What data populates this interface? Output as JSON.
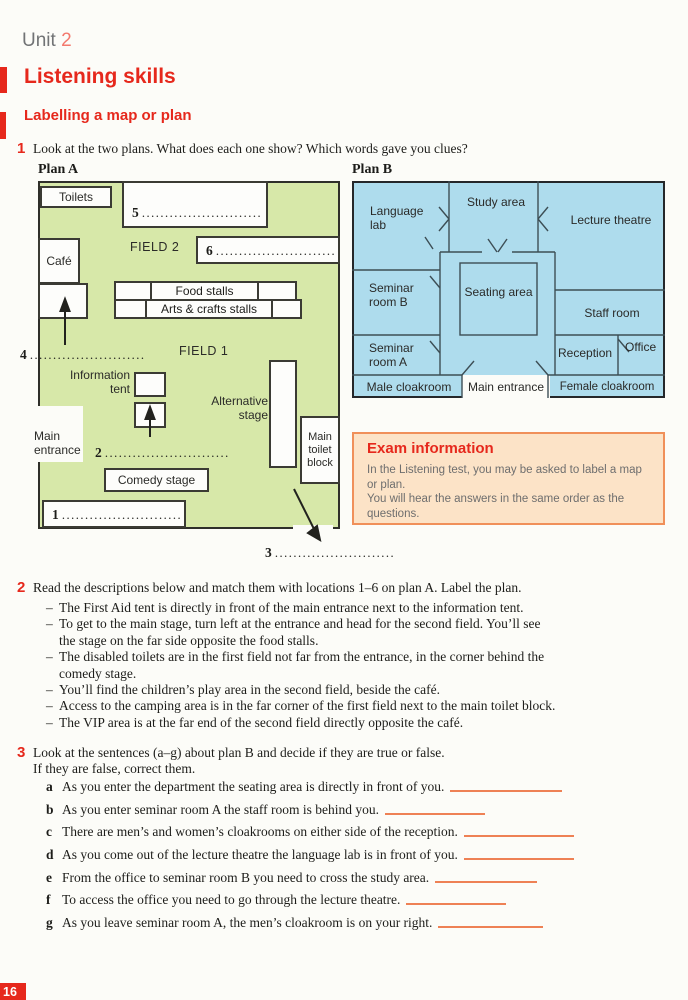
{
  "header": {
    "unit_label": "Unit",
    "unit_number": "2",
    "title": "Listening skills",
    "subtitle": "Labelling a map or plan"
  },
  "exercise1": {
    "number": "1",
    "text": "Look at the two plans. What does each one show? Which words gave you clues?"
  },
  "plan_a": {
    "title": "Plan A",
    "labels": {
      "toilets": "Toilets",
      "cafe": "Café",
      "field2": "FIELD 2",
      "field1": "FIELD 1",
      "food_stalls": "Food stalls",
      "arts_crafts_stalls": "Arts & crafts stalls",
      "information_tent": "Information tent",
      "alternative_stage": "Alternative stage",
      "main_entrance": "Main entrance",
      "comedy_stage": "Comedy stage",
      "main_toilet_block": "Main toilet block"
    },
    "blanks": {
      "n1": "1",
      "d1": "..........................",
      "n2": "2",
      "d2": "...........................",
      "n3": "3",
      "d3": "..........................",
      "n4": "4",
      "d4": ".........................",
      "n5": "5",
      "d5": "..........................",
      "n6": "6",
      "d6": ".........................."
    }
  },
  "plan_b": {
    "title": "Plan B",
    "labels": {
      "language_lab": "Language lab",
      "study_area": "Study area",
      "lecture_theatre": "Lecture theatre",
      "seminar_room_b": "Seminar room B",
      "seating_area": "Seating area",
      "staff_room": "Staff room",
      "seminar_room_a": "Seminar room A",
      "reception": "Reception",
      "office": "Office",
      "male_cloakroom": "Male cloakroom",
      "main_entrance": "Main entrance",
      "female_cloakroom": "Female cloakroom"
    }
  },
  "exam_info": {
    "title": "Exam information",
    "body": "In the Listening test, you may be asked to label a map or plan.\nYou will hear the answers in the same order as the questions."
  },
  "exercise2": {
    "number": "2",
    "intro": "Read the descriptions below and match them with locations 1–6 on plan A. Label the plan.",
    "bullet": "–",
    "items": [
      "The First Aid tent is directly in front of the main entrance next to the information tent.",
      "To get to the main stage, turn left at the entrance and head for the second field. You’ll see\nthe stage on the far side opposite the food stalls.",
      "The disabled toilets are in the first field not far from the entrance, in the corner behind the\ncomedy stage.",
      "You’ll find the children’s play area in the second field, beside the café.",
      "Access to the camping area is in the far corner of the first field next to the main toilet block.",
      "The VIP area is at the far end of the second field directly opposite the café."
    ]
  },
  "exercise3": {
    "number": "3",
    "intro": "Look at the sentences (a–g) about plan B and decide if they are true or false.\nIf they are false, correct them.",
    "items": [
      {
        "letter": "a",
        "text": "As you enter the department the seating area is directly in front of you."
      },
      {
        "letter": "b",
        "text": "As you enter seminar room A the staff room is behind you."
      },
      {
        "letter": "c",
        "text": "There are men’s and women’s cloakrooms on either side of the reception."
      },
      {
        "letter": "d",
        "text": "As you come out of the lecture theatre the language lab is in front of you."
      },
      {
        "letter": "e",
        "text": "From the office to seminar room B you need to cross the study area."
      },
      {
        "letter": "f",
        "text": "To access the office you need to go through the lecture theatre."
      },
      {
        "letter": "g",
        "text": "As you leave seminar room A, the men’s cloakroom is on your right."
      }
    ]
  },
  "footer": {
    "page_number": "16"
  },
  "colors": {
    "accent_red": "#e6281c",
    "plan_a_fill": "#d7e8a9",
    "plan_b_fill": "#aedced",
    "exam_fill": "#fce3c7",
    "exam_border": "#f0905a",
    "answer_line": "#ee8155"
  }
}
